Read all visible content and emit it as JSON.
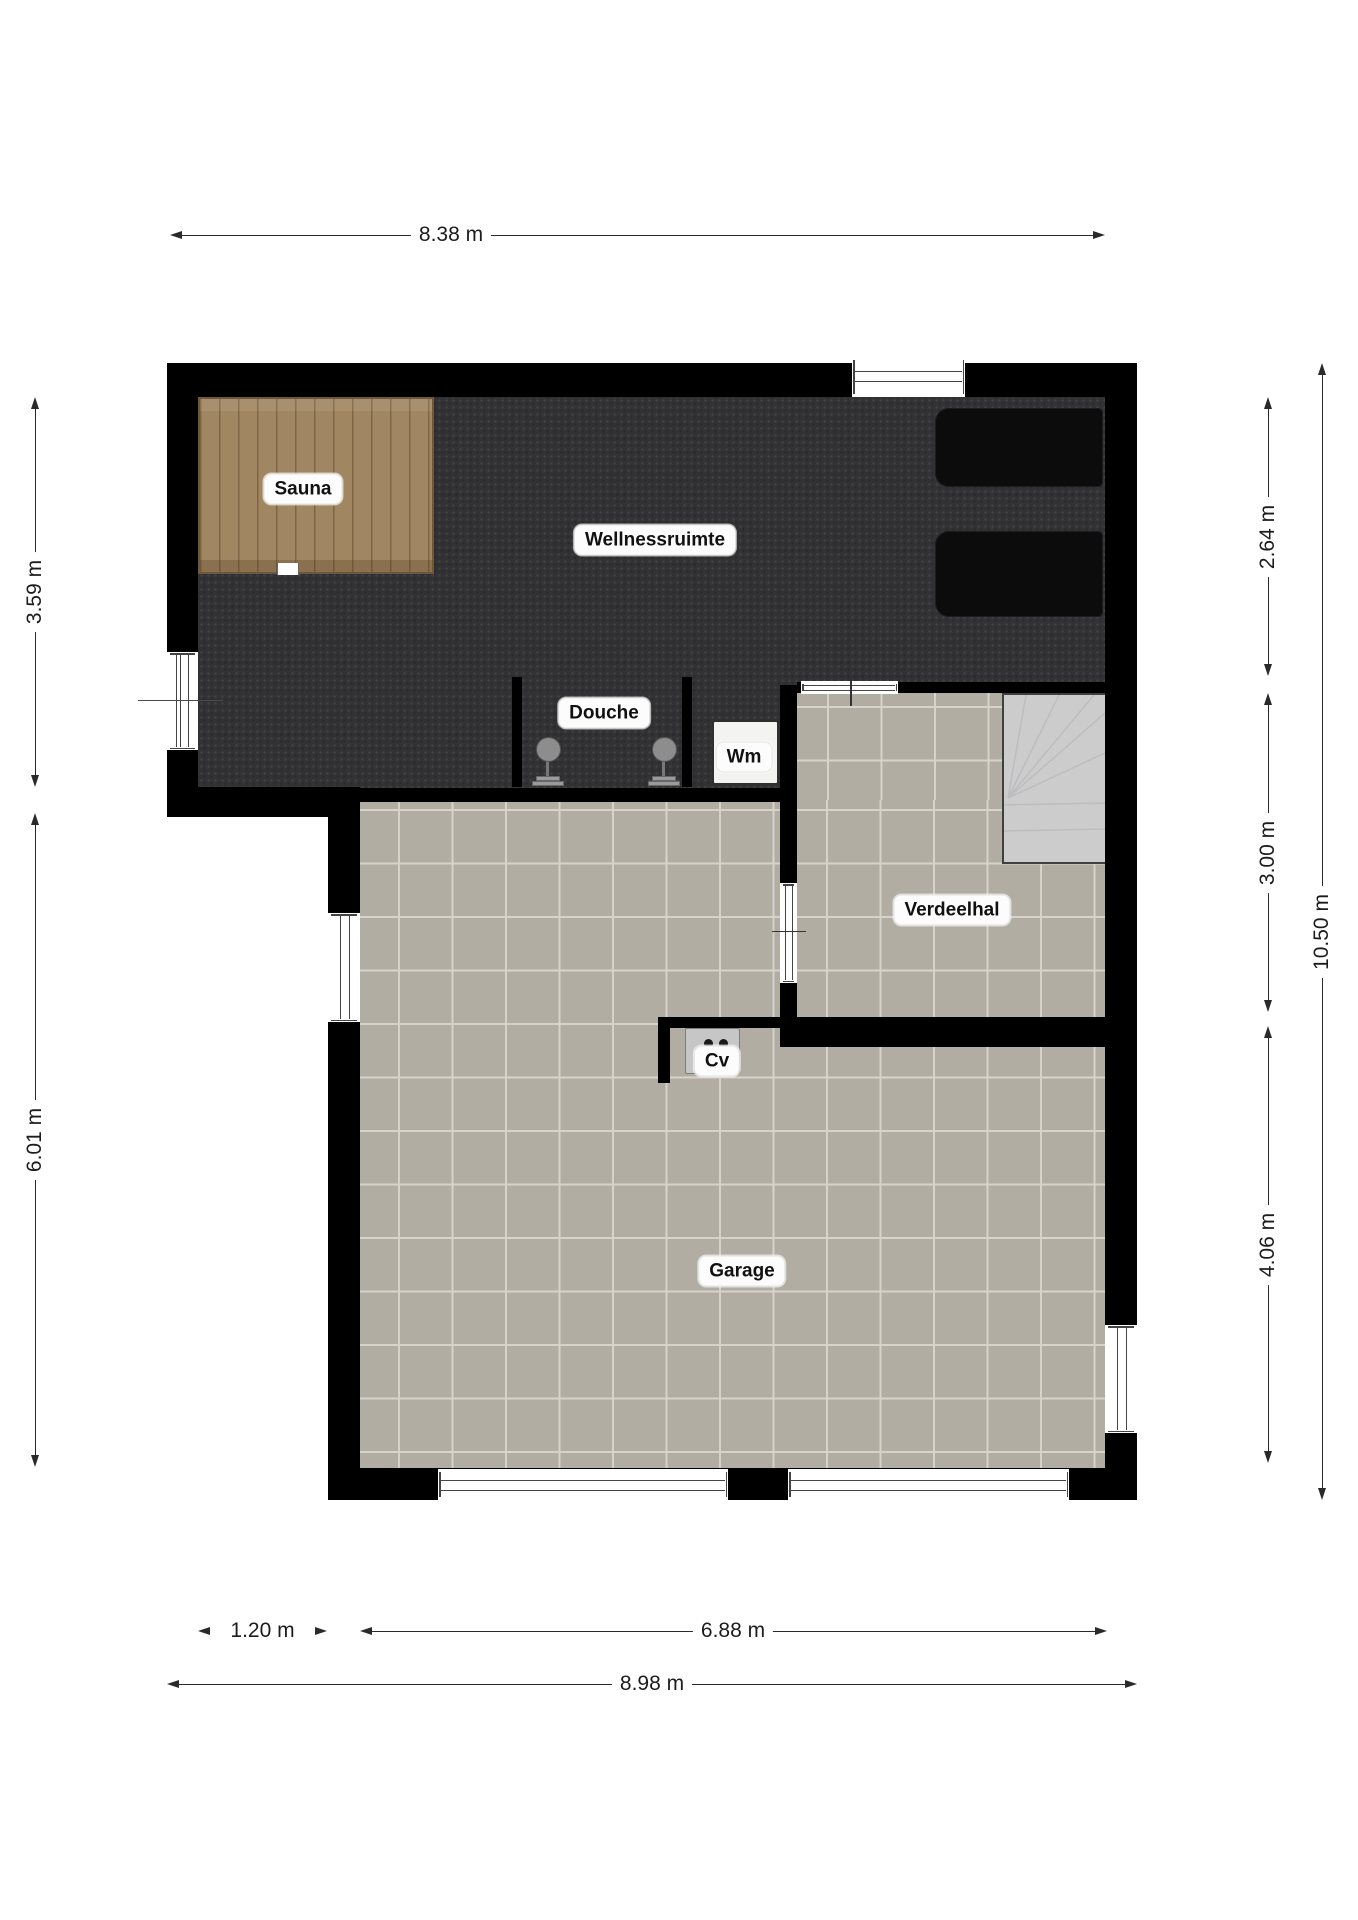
{
  "rooms": {
    "wellnessruimte": {
      "label": "Wellnessruimte"
    },
    "sauna": {
      "label": "Sauna"
    },
    "douche": {
      "label": "Douche"
    },
    "wm": {
      "label": "Wm"
    },
    "verdeelhal": {
      "label": "Verdeelhal"
    },
    "cv": {
      "label": "Cv"
    },
    "garage": {
      "label": "Garage"
    }
  },
  "dimensions": {
    "top_width": {
      "label": "8.38 m"
    },
    "left_upper": {
      "label": "3.59 m"
    },
    "left_lower": {
      "label": "6.01 m"
    },
    "right_upper": {
      "label": "2.64 m"
    },
    "right_middle": {
      "label": "3.00 m"
    },
    "right_lower": {
      "label": "4.06 m"
    },
    "right_total": {
      "label": "10.50 m"
    },
    "bottom_offset": {
      "label": "1.20 m"
    },
    "bottom_garage": {
      "label": "6.88 m"
    },
    "bottom_total": {
      "label": "8.98 m"
    }
  },
  "furniture": {
    "loungers": 2,
    "showers": 2,
    "washing_machine": "Wm",
    "boiler": "Cv",
    "stairs": "winder-staircase"
  },
  "colors": {
    "wall": "#000000",
    "wellness_floor": "#323234",
    "tile_floor": "#b1ada3",
    "tile_grout": "#d6d3cc",
    "sauna_wood": "#a18662",
    "stairs": "#cccccd",
    "lounger": "#0c0c0c",
    "label_bg": "#fcfcfc",
    "dimension_line": "#2a2a2a"
  }
}
